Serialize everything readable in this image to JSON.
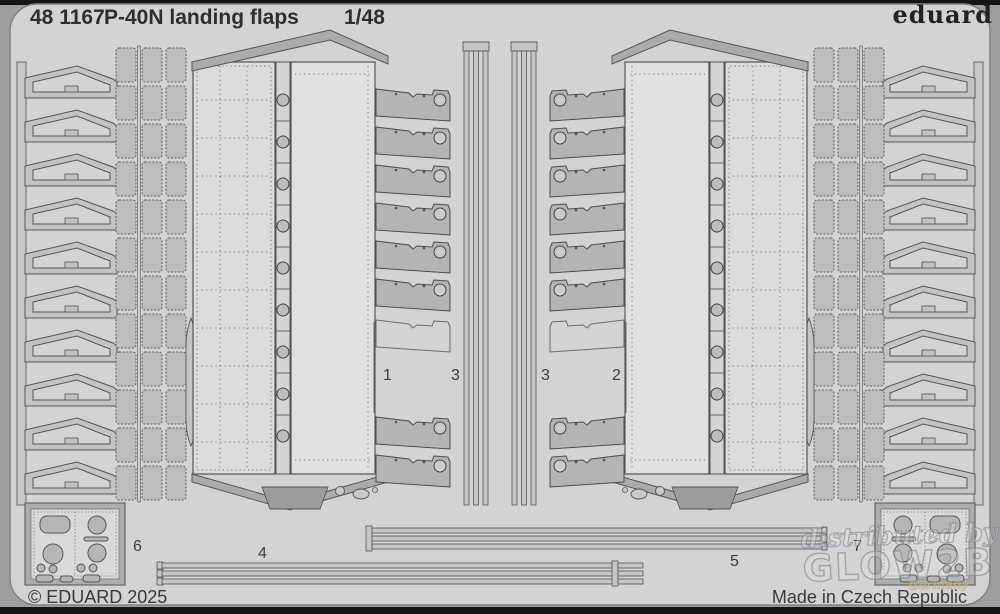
{
  "header": {
    "catalog_number": "48 1167",
    "product_name": "P-40N landing flaps",
    "scale": "1/48",
    "brand": "eduard"
  },
  "footer": {
    "copyright": "© EDUARD 2025",
    "origin": "Made in Czech Republic"
  },
  "watermark": {
    "line1": "distributed by",
    "line2": "GLOW2B",
    "line3": "Germany"
  },
  "part_labels": {
    "flap_left": "1",
    "flap_right": "2",
    "vstrip_left": "3",
    "vstrip_right": "3",
    "hstrip_left": "4",
    "hstrip_right": "5",
    "plate_left": "6",
    "plate_right": "7"
  },
  "colors": {
    "background": "#9e9e9e",
    "sheet": "#d3d3d3",
    "part_fill": "#b4b4b4",
    "panel_fill": "#dedede",
    "outline": "#4c4c4c",
    "text": "#2e2e2e",
    "watermark_stroke": "#6e7a88"
  }
}
